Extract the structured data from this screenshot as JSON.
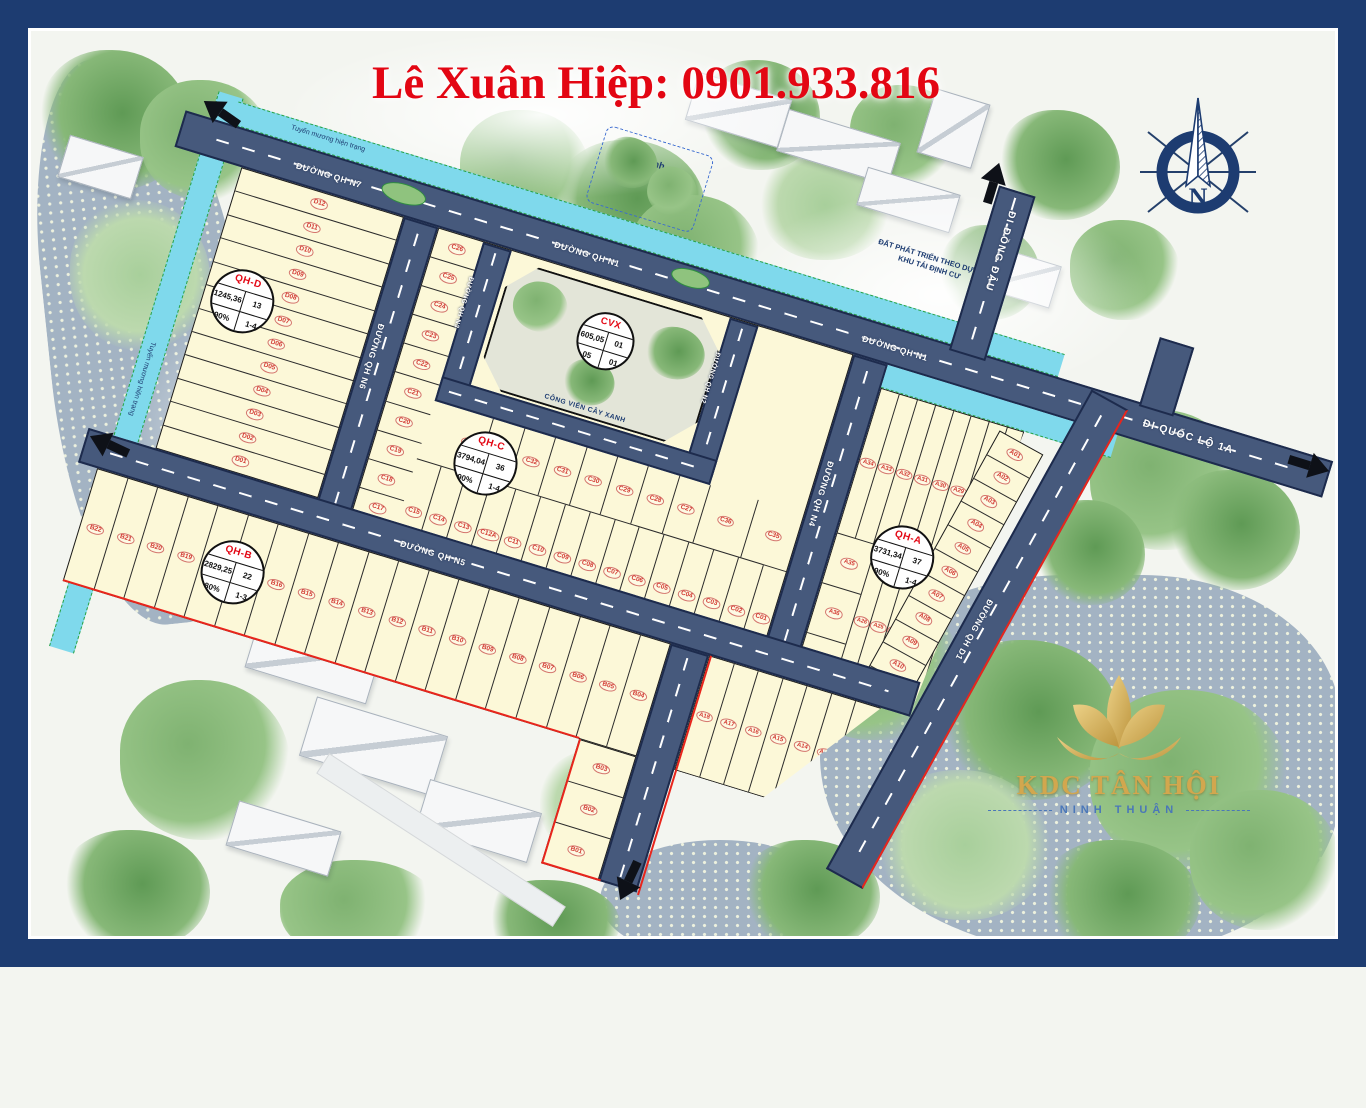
{
  "header": {
    "contact": "Lê Xuân Hiệp: 0901.933.816"
  },
  "colors": {
    "frame": "#1d3c71",
    "road": "#46597c",
    "block": "#fcf8d8",
    "channel": "#7fd9ec",
    "water": "#a3b3c3",
    "boundary_red": "#e8251c",
    "lot_red": "#d43b33",
    "title_red": "#e30613",
    "logo_gold": "#d2a74e"
  },
  "compass": {
    "north": "N"
  },
  "logo": {
    "name": "KDC TÂN HỘI",
    "province": "NINH THUẬN"
  },
  "labels": {
    "channel_top": "Tuyến mương hiện trạng",
    "channel_left": "Tuyến mương hiện trạng",
    "temple": [
      "Đình",
      "Tân Hội"
    ],
    "dev_note": [
      "ĐẤT PHÁT TRIỂN THEO DỰ ÁN",
      "KHU TÁI ĐỊNH CƯ"
    ]
  },
  "roads": {
    "n1": "ĐƯỜNG QH N1",
    "n2": "ĐƯỜNG QH N2",
    "n3": "ĐƯỜNG QH N3",
    "n4": "ĐƯỜNG QH N4",
    "n5": "ĐƯỜNG QH N5",
    "n6": "ĐƯỜNG QH N6",
    "n7": "ĐƯỜNG QH N7",
    "d1": "ĐƯỜNG QH D1",
    "exit_ne": "ĐI ĐỒNG ĐẬU",
    "exit_e": "ĐI QUỐC LỘ 1A"
  },
  "park": {
    "id": "CVX",
    "area": "605,05",
    "count": "01",
    "left": "05",
    "right": "01",
    "caption": "CÔNG VIÊN CÂY XANH"
  },
  "blocks": {
    "qh_d": {
      "id": "QH-D",
      "area": "1245,36",
      "count": "13",
      "coverage": "90%",
      "floors": "1-4"
    },
    "qh_c": {
      "id": "QH-C",
      "area": "3794,04",
      "count": "36",
      "coverage": "90%",
      "floors": "1-4"
    },
    "qh_a": {
      "id": "QH-A",
      "area": "3731,34",
      "count": "37",
      "coverage": "90%",
      "floors": "1-4"
    },
    "qh_b": {
      "id": "QH-B",
      "area": "2829,25",
      "count": "22",
      "coverage": "80%",
      "floors": "1-3"
    }
  },
  "lots": {
    "d_col": [
      "D12",
      "D11",
      "D10",
      "D09",
      "D08",
      "D07",
      "D06",
      "D05",
      "D04",
      "D03",
      "D02",
      "D01"
    ],
    "c_left": [
      "C26",
      "C25",
      "C24",
      "C23",
      "C22",
      "C21",
      "C20",
      "C19",
      "C18",
      "C17",
      "C16"
    ],
    "c_mid": [
      "C34",
      "C33",
      "C32",
      "C31",
      "C30",
      "C29",
      "C28",
      "C27"
    ],
    "c_pair": [
      "C36",
      "C35"
    ],
    "c_bottom": [
      "C15",
      "C14",
      "C13",
      "C12A",
      "C11",
      "C10",
      "C09",
      "C08",
      "C07",
      "C06",
      "C05",
      "C04",
      "C03",
      "C02",
      "C01"
    ],
    "a_top": [
      "A34",
      "A33",
      "A32",
      "A31",
      "A30",
      "A29",
      "A28",
      "A27"
    ],
    "a_mid": [
      "A26",
      "A25",
      "A24",
      "A23",
      "A22",
      "A21",
      "A20",
      "A19"
    ],
    "a_left": [
      "A35",
      "A36",
      "A37"
    ],
    "a_right": [
      "A01",
      "A02",
      "A03",
      "A04",
      "A05",
      "A06",
      "A07",
      "A08",
      "A09",
      "A10",
      "A11"
    ],
    "a_tri": [
      "A18",
      "A17",
      "A16",
      "A15",
      "A14",
      "A12A",
      "A12"
    ],
    "b_row": [
      "B22",
      "B21",
      "B20",
      "B19",
      "B18",
      "B17",
      "B16",
      "B15",
      "B14",
      "B13",
      "B12",
      "B11",
      "B10",
      "B09",
      "B08",
      "B07",
      "B06",
      "B05",
      "B04"
    ],
    "b_tail": [
      "B03",
      "B02",
      "B01"
    ]
  }
}
